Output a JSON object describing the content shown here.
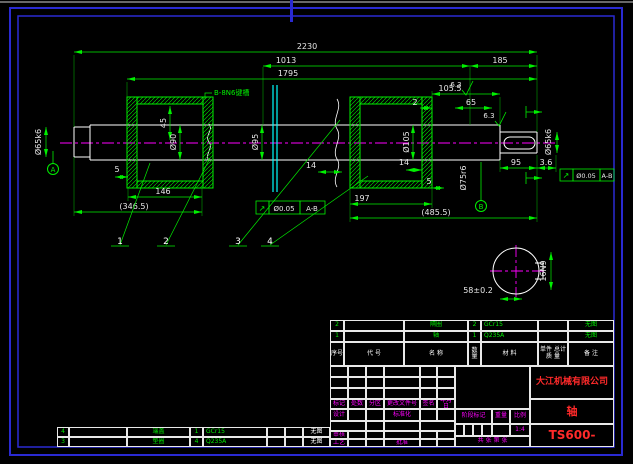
{
  "sheet": {
    "company": "大江机械有限公司",
    "part_name": "轴",
    "drawing_number": "TS600-",
    "scale": "1:4"
  },
  "colors": {
    "line_green": "#00ef00",
    "dim_white": "#e8e8e8",
    "centerline_magenta": "#ff00ff",
    "cyan": "#00ffff",
    "border_blue": "#2a2ad2",
    "title_red": "#ff2a2a"
  },
  "bom": {
    "headers": {
      "seq": "序号",
      "code": "代 号",
      "name": "名 称",
      "qty": "数量",
      "material": "材 料",
      "weight_top": "单件 总计",
      "weight_bottom": "质 量",
      "remark": "备 注"
    },
    "rows": [
      {
        "seq": "2",
        "code": "",
        "name": "隔圈",
        "qty": "2",
        "material": "GCr15",
        "weight": "",
        "remark": "无图"
      },
      {
        "seq": "1",
        "code": "",
        "name": "轴",
        "qty": "1",
        "material": "Q235A",
        "weight": "",
        "remark": "无图"
      }
    ],
    "continuation_rows": [
      {
        "seq": "4",
        "code": "",
        "name": "端盖",
        "qty": "1",
        "material": "GCr15",
        "weight": "",
        "remark": "无图"
      },
      {
        "seq": "3",
        "code": "",
        "name": "垫圈",
        "qty": "4",
        "material": "Q235A",
        "weight": "",
        "remark": "无图"
      }
    ]
  },
  "title_block": {
    "rev_header": [
      "标记",
      "处数",
      "分区",
      "更改文件号",
      "签名",
      "年月日"
    ],
    "roles": {
      "design": "设计",
      "standardize": "标准化",
      "review": "审核",
      "process": "工艺",
      "approve": "批准"
    },
    "stage_mark": "阶段标记",
    "weight": "重量",
    "scale_label": "比例",
    "scale": "1:4",
    "sheet_info": "共 张 第 张"
  },
  "drawing": {
    "dims": {
      "overall": "2230",
      "mid": "1013",
      "right_end": "185",
      "inner": "1795",
      "step": "105.5",
      "gap2": "2",
      "key_len_top": "65",
      "hub_w": "45",
      "d90": "Ø90",
      "d95": "Ø95",
      "d105": "Ø105",
      "d75": "Ø75r6",
      "d65_left": "Ø65k6",
      "d65_right": "Ø65k6",
      "chamfer_l": "5",
      "seg146": "146",
      "seg346": "(346.5)",
      "plate14a": "14",
      "plate14b": "14",
      "chamfer_r": "5",
      "seg197": "197",
      "seg485": "(485.5)",
      "key95": "95",
      "end36": "3.6"
    },
    "section": {
      "label_width": "16N9",
      "label_depth": "58±0.2"
    },
    "notes": {
      "keyway": "B-8N6键槽"
    },
    "datums": {
      "a": "A",
      "b": "B"
    },
    "balloons": [
      "1",
      "2",
      "3",
      "4"
    ],
    "tolerance": {
      "symbol": "↗",
      "value": "Ø0.05",
      "datum": "A-B"
    },
    "roughness": "6.3"
  }
}
